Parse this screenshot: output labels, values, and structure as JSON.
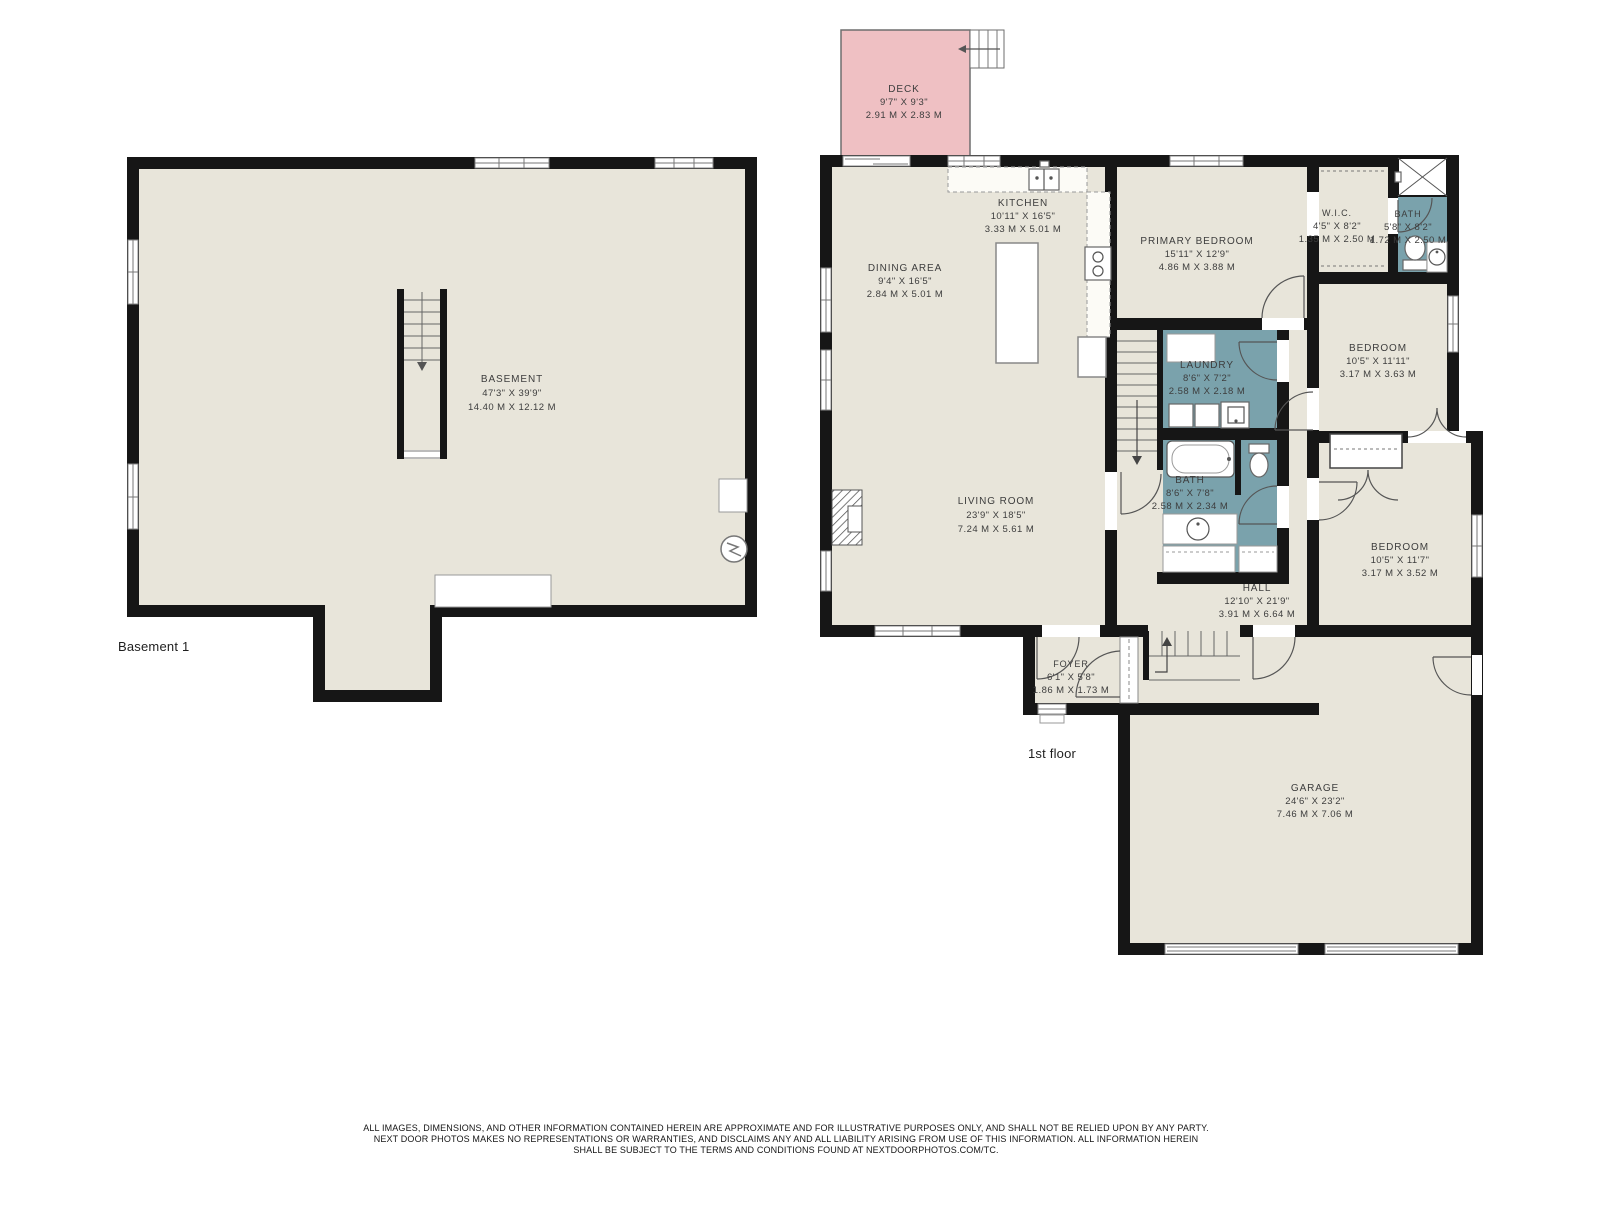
{
  "plans": {
    "basement": {
      "floor_label": "Basement 1",
      "rooms": {
        "basement": {
          "name": "BASEMENT",
          "imperial": "47'3\" X 39'9\"",
          "metric": "14.40 M X 12.12 M"
        }
      }
    },
    "first_floor": {
      "floor_label": "1st floor",
      "rooms": {
        "deck": {
          "name": "DECK",
          "imperial": "9'7\" X 9'3\"",
          "metric": "2.91 M X 2.83 M"
        },
        "kitchen": {
          "name": "KITCHEN",
          "imperial": "10'11\" X 16'5\"",
          "metric": "3.33 M X 5.01 M"
        },
        "dining_area": {
          "name": "DINING AREA",
          "imperial": "9'4\" X 16'5\"",
          "metric": "2.84 M X 5.01 M"
        },
        "primary_bedroom": {
          "name": "PRIMARY BEDROOM",
          "imperial": "15'11\" X 12'9\"",
          "metric": "4.86 M X 3.88 M"
        },
        "wic": {
          "name": "W.I.C.",
          "imperial": "4'5\" X 8'2\"",
          "metric": "1.35 M X 2.50 M"
        },
        "bath_primary": {
          "name": "BATH",
          "imperial": "5'8\" X 8'2\"",
          "metric": "1.72 M X 2.50 M"
        },
        "bedroom_ne": {
          "name": "BEDROOM",
          "imperial": "10'5\" X 11'11\"",
          "metric": "3.17 M X 3.63 M"
        },
        "laundry": {
          "name": "LAUNDRY",
          "imperial": "8'6\" X 7'2\"",
          "metric": "2.58 M X 2.18 M"
        },
        "bath_hall": {
          "name": "BATH",
          "imperial": "8'6\" X 7'8\"",
          "metric": "2.58 M X 2.34 M"
        },
        "living_room": {
          "name": "LIVING ROOM",
          "imperial": "23'9\" X 18'5\"",
          "metric": "7.24 M X 5.61 M"
        },
        "hall": {
          "name": "HALL",
          "imperial": "12'10\" X 21'9\"",
          "metric": "3.91 M X 6.64 M"
        },
        "bedroom_se": {
          "name": "BEDROOM",
          "imperial": "10'5\" X 11'7\"",
          "metric": "3.17 M X 3.52 M"
        },
        "foyer": {
          "name": "FOYER",
          "imperial": "6'1\" X 5'8\"",
          "metric": "1.86 M X 1.73 M"
        },
        "garage": {
          "name": "GARAGE",
          "imperial": "24'6\" X 23'2\"",
          "metric": "7.46 M X 7.06 M"
        }
      }
    }
  },
  "footer": {
    "line1": "ALL IMAGES, DIMENSIONS, AND OTHER INFORMATION CONTAINED HEREIN ARE APPROXIMATE AND FOR ILLUSTRATIVE PURPOSES ONLY, AND SHALL NOT BE RELIED UPON BY ANY PARTY.",
    "line2": "NEXT DOOR PHOTOS MAKES NO REPRESENTATIONS OR WARRANTIES, AND DISCLAIMS ANY AND ALL LIABILITY ARISING FROM USE OF THIS INFORMATION. ALL INFORMATION HEREIN",
    "line3": "SHALL BE SUBJECT TO THE TERMS AND CONDITIONS FOUND AT NEXTDOORPHOTOS.COM/TC."
  },
  "colors": {
    "floor": "#e8e5da",
    "wet_room": "#7aa2ac",
    "deck": "#efc0c3",
    "wall": "#161616",
    "label": "#3d3d3d"
  }
}
